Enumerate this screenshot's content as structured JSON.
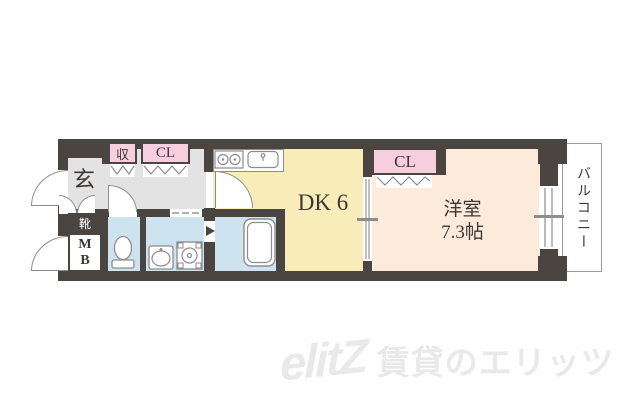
{
  "title": "apartment-floor-plan",
  "colors": {
    "wall": "#4a4541",
    "hall": "#e3e3e4",
    "dk": "#f8edb9",
    "western": "#fcebdb",
    "wet": "#cde3ef",
    "pink": "#f6cede",
    "line": "#8d8d8d",
    "balcony_border": "#9b9b9b",
    "watermark": "#e9e9e9",
    "text": "#3b3734"
  },
  "rooms": {
    "genkan": "玄",
    "shoes": "靴",
    "mb_letters": [
      "M",
      "B"
    ],
    "storage": "収",
    "closet_hall": "CL",
    "closet_west": "CL",
    "dk": "DK 6",
    "western_line1": "洋室",
    "western_line2": "7.3帖",
    "balcony": "バルコニー"
  },
  "watermark": {
    "logo": "elitZ",
    "text": "賃貸のエリッツ"
  },
  "icons": [
    "stove-icon",
    "sink-icon",
    "toilet-icon",
    "washbasin-icon",
    "washing-machine-icon",
    "bathtub-icon",
    "entrance-door-swing-icon",
    "mb-door-swing-icon",
    "toilet-door-swing-icon",
    "dk-door-swing-icon",
    "genkan-double-door-icon",
    "bifold-door-icon",
    "sliding-door-icon",
    "balcony-window-icon",
    "bathroom-folding-door-icon"
  ]
}
